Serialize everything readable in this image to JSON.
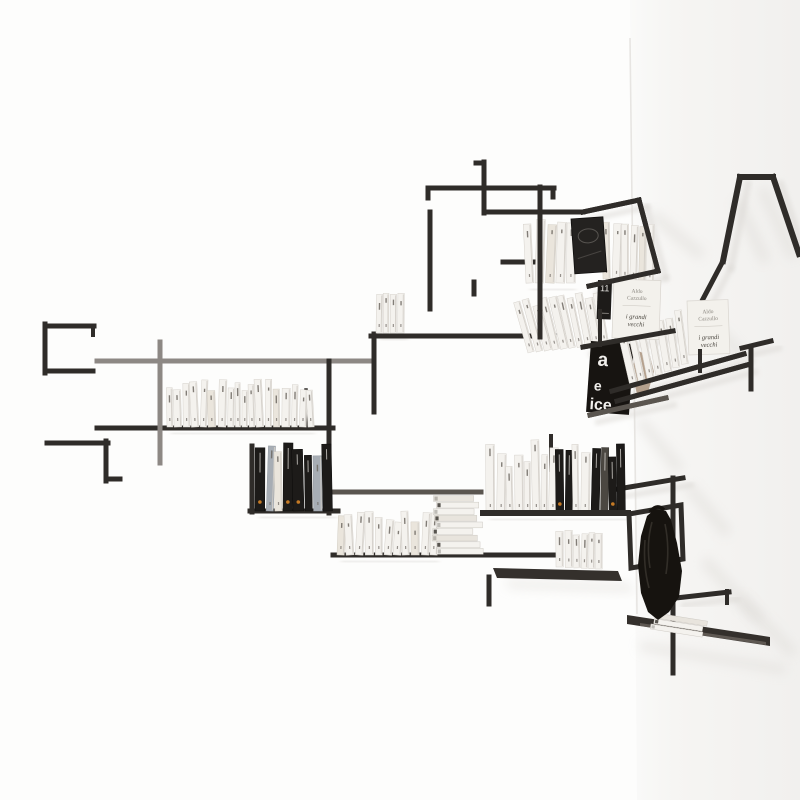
{
  "meta": {
    "subject": "wall-mounted modular rod bookshelf in white corner studio",
    "walls": "two white walls meeting at a corner, soft diagonal shadows on right wall"
  },
  "palette": {
    "wall": "#fdfdfc",
    "wall_right_a": "#fafaf9",
    "wall_right_b": "#f1f0ee",
    "corner": "#e7e5e2",
    "shadow": "#dcd9d5",
    "rod_dark": "#2f2c29",
    "rod_mid": "#5a554f",
    "rod_light": "#8d8884",
    "book_white": "#f4f2ee",
    "book_black": "#1d1b19",
    "accent_orange": "#c57a25",
    "plate": "#34302c",
    "plate_light": "#817a72",
    "bag": "#16130f",
    "bag_hi": "#3e3a33",
    "poster_bg": "#171411",
    "poster_text": "#f1efec",
    "cover_bg": "#f3f1ec",
    "cover_text": "#8a867f",
    "cover_text_dark": "#4a463f",
    "torn_paper": "#a9927b"
  },
  "texts": {
    "cover_author_line1": "Aldo",
    "cover_author_line2": "Cazzullo",
    "cover_title_line1": "i grandi",
    "cover_title_line2": "vecchi",
    "spine_number": "11",
    "poster_letters": [
      "a",
      "e",
      "ice"
    ]
  },
  "scene": {
    "seed": 11,
    "corner": {
      "x1": 630,
      "y1": 38,
      "x2": 637,
      "y2": 614
    },
    "rods": [
      [
        45,
        326,
        94,
        326,
        5,
        "d"
      ],
      [
        45,
        324,
        45,
        373,
        5,
        "d"
      ],
      [
        45,
        371,
        93,
        371,
        5,
        "d"
      ],
      [
        93,
        326,
        93,
        335,
        4,
        "d"
      ],
      [
        47,
        443,
        108,
        443,
        5,
        "d"
      ],
      [
        106,
        441,
        106,
        481,
        5,
        "d"
      ],
      [
        106,
        479,
        120,
        479,
        5,
        "d"
      ],
      [
        97,
        361,
        374,
        361,
        5,
        "l"
      ],
      [
        97,
        428,
        333,
        428,
        5,
        "d"
      ],
      [
        160,
        342,
        160,
        463,
        5,
        "l"
      ],
      [
        329,
        361,
        329,
        513,
        5,
        "d"
      ],
      [
        252,
        446,
        252,
        512,
        5,
        "d"
      ],
      [
        250,
        511,
        338,
        511,
        5,
        "d"
      ],
      [
        331,
        492,
        481,
        492,
        5,
        "m"
      ],
      [
        333,
        555,
        558,
        555,
        5,
        "d"
      ],
      [
        306,
        390,
        306,
        426,
        3.5,
        "d"
      ],
      [
        374,
        334,
        374,
        412,
        5,
        "d"
      ],
      [
        371,
        336,
        554,
        336,
        5,
        "d"
      ],
      [
        428,
        188,
        554,
        188,
        5,
        "d"
      ],
      [
        428,
        188,
        428,
        198,
        5,
        "d"
      ],
      [
        553,
        188,
        553,
        197,
        5,
        "d"
      ],
      [
        484,
        162,
        484,
        213,
        5,
        "d"
      ],
      [
        476,
        163,
        484,
        163,
        5,
        "d"
      ],
      [
        484,
        212,
        583,
        212,
        5,
        "d"
      ],
      [
        540,
        187,
        540,
        337,
        5,
        "d"
      ],
      [
        503,
        262,
        540,
        262,
        5,
        "d"
      ],
      [
        430,
        212,
        430,
        309,
        5,
        "d"
      ],
      [
        474,
        282,
        474,
        294,
        5,
        "d"
      ],
      [
        483,
        513,
        628,
        513,
        6,
        "d"
      ],
      [
        551,
        436,
        551,
        470,
        4,
        "d"
      ],
      [
        489,
        577,
        489,
        604,
        5,
        "d"
      ],
      [
        583,
        212,
        639,
        200,
        5,
        "d"
      ],
      [
        639,
        200,
        658,
        271,
        5,
        "d"
      ],
      [
        658,
        271,
        589,
        286,
        5,
        "d"
      ],
      [
        612,
        391,
        744,
        354,
        5,
        "d"
      ],
      [
        617,
        401,
        747,
        365,
        5,
        "d"
      ],
      [
        700,
        351,
        700,
        371,
        4,
        "d"
      ],
      [
        751,
        349,
        751,
        389,
        5,
        "d"
      ],
      [
        742,
        348,
        771,
        341,
        5,
        "d"
      ],
      [
        740,
        177,
        773,
        177,
        6,
        "d"
      ],
      [
        740,
        177,
        723,
        261,
        6,
        "d"
      ],
      [
        723,
        261,
        703,
        299,
        5,
        "d"
      ],
      [
        773,
        177,
        799,
        254,
        6,
        "d"
      ],
      [
        583,
        347,
        673,
        331,
        5,
        "d"
      ],
      [
        600,
        311,
        600,
        345,
        4,
        "d"
      ],
      [
        590,
        415,
        666,
        398,
        5,
        "m"
      ],
      [
        618,
        489,
        683,
        478,
        5,
        "d"
      ],
      [
        673,
        478,
        673,
        673,
        5,
        "d"
      ],
      [
        676,
        598,
        729,
        592,
        5,
        "d"
      ],
      [
        727,
        591,
        727,
        603,
        4,
        "d"
      ]
    ],
    "front_rods": [
      [
        540,
        187,
        540,
        337,
        5,
        "d"
      ],
      [
        583,
        212,
        639,
        200,
        5,
        "d"
      ],
      [
        639,
        200,
        658,
        271,
        5,
        "d"
      ],
      [
        658,
        271,
        589,
        286,
        5,
        "d"
      ],
      [
        612,
        391,
        744,
        354,
        5,
        "d"
      ],
      [
        617,
        401,
        747,
        365,
        5,
        "d"
      ],
      [
        700,
        351,
        700,
        371,
        4,
        "d"
      ],
      [
        583,
        347,
        673,
        331,
        5,
        "d"
      ],
      [
        600,
        311,
        600,
        345,
        4,
        "d"
      ],
      [
        590,
        415,
        666,
        398,
        5,
        "m"
      ],
      [
        483,
        513,
        628,
        513,
        6,
        "d"
      ]
    ],
    "loop_frame": "629,514 681,505 683,559 631,568",
    "plates": [
      {
        "points": "493,568 618,571 622,581 497,578",
        "fill": "plate",
        "opacity": 1
      },
      {
        "points": "627,615 770,637 770,646 627,624",
        "fill": "plate",
        "opacity": 1
      },
      {
        "points": "640,623 766,642 766,645 640,626",
        "fill": "plate_light",
        "opacity": 0.55
      }
    ],
    "plate_shadows": [
      "505,580 630,584 634,592 509,588",
      "640,642 786,666 786,674 640,650"
    ],
    "right_shadows": [
      [
        652,
        214,
        702,
        256
      ],
      [
        737,
        200,
        766,
        262
      ],
      [
        762,
        188,
        794,
        258
      ],
      [
        700,
        312,
        744,
        357
      ],
      [
        640,
        420,
        680,
        470
      ],
      [
        688,
        486,
        728,
        534
      ],
      [
        704,
        560,
        760,
        620
      ],
      [
        739,
        598,
        794,
        654
      ]
    ],
    "book_rows": [
      {
        "x0": 167,
        "x1": 309,
        "base": 427,
        "hmin": 36,
        "hmax": 48,
        "wmin": 5,
        "wmax": 8.5,
        "lean": 3,
        "pal": "w",
        "gap": 1.2
      },
      {
        "x0": 376,
        "x1": 402,
        "base": 333,
        "hmin": 37,
        "hmax": 41,
        "wmin": 5.5,
        "wmax": 7,
        "lean": 1,
        "pal": "w",
        "gap": 0.6
      },
      {
        "x0": 255,
        "x1": 331,
        "base": 511,
        "hmin": 52,
        "hmax": 70,
        "wmin": 6.5,
        "wmax": 11,
        "lean": 2,
        "pal": "mixL",
        "gap": 0.5
      },
      {
        "x0": 337,
        "x1": 433,
        "base": 555,
        "hmin": 32,
        "hmax": 44,
        "wmin": 6,
        "wmax": 8.5,
        "lean": 4,
        "pal": "w",
        "gap": 1
      },
      {
        "x0": 486,
        "x1": 553,
        "base": 513,
        "hmin": 46,
        "hmax": 74,
        "wmin": 6,
        "wmax": 9,
        "lean": 2,
        "pal": "w2",
        "gap": 0.7
      },
      {
        "x0": 556,
        "x1": 622,
        "base": 513,
        "hmin": 56,
        "hmax": 72,
        "wmin": 6,
        "wmax": 10,
        "lean": 1.5,
        "pal": "blk",
        "gap": 0.5
      },
      {
        "x0": 556,
        "x1": 599,
        "base": 567,
        "slope": 0.05,
        "hmin": 33,
        "hmax": 40,
        "wmin": 5.5,
        "wmax": 7.5,
        "lean": 2,
        "pal": "w",
        "gap": 0.8
      },
      {
        "x0": 526,
        "x1": 570,
        "base": 283,
        "hmin": 56,
        "hmax": 65,
        "wmin": 7,
        "wmax": 9.5,
        "lean": 3,
        "pal": "wg",
        "gap": 0.8
      },
      {
        "x0": 603,
        "x1": 647,
        "base": 279,
        "slope": 0.1,
        "hmin": 52,
        "hmax": 60,
        "wmin": 6,
        "wmax": 9,
        "lean": 2,
        "pal": "w",
        "gap": 0.8
      }
    ],
    "fans": [
      {
        "x0": 528,
        "n": 10,
        "dx": 8.2,
        "base": 353,
        "dbase": -0.9,
        "h": 50,
        "w": 7,
        "rot": -16,
        "drot": 0.7,
        "z": "back"
      },
      {
        "x0": 630,
        "n": 7,
        "dx": 8.6,
        "base": 386,
        "dbase": -3.6,
        "h": 52,
        "w": 7.5,
        "rot": -13,
        "drot": 0.9,
        "z": "front"
      }
    ],
    "flat_stacks": [
      {
        "x": 434,
        "y": 555,
        "n": 9,
        "w": 47,
        "h": 6.6,
        "jx": 3,
        "rot": 0
      },
      {
        "x": 652,
        "y": 630,
        "n": 3,
        "w": 56,
        "h": 5.8,
        "jx": 2,
        "rot": 9
      }
    ],
    "covers": [
      {
        "x": 614,
        "y": 279,
        "w": 47,
        "h": 59,
        "rot": 2
      },
      {
        "x": 687,
        "y": 301,
        "w": 41,
        "h": 54,
        "rot": -2
      }
    ],
    "album": {
      "x": 571,
      "y": 219,
      "w": 32,
      "h": 55,
      "rot": -4
    },
    "spine11": {
      "x": 598,
      "y": 280,
      "w": 14,
      "h": 39,
      "rot": 2
    },
    "poster": {
      "x": 591,
      "y": 341,
      "w": 43,
      "h": 71,
      "rot": 4
    },
    "torn_paper": "636,350 650,356 654,372 648,392 638,398 632,374",
    "bag": {
      "points": "655,509 666,511 671,520 677,543 682,571 679,597 669,612 658,620 648,612 641,593 638,565 641,536 647,516",
      "strap": "M650,512 q7,-9 14,-2",
      "folds": [
        "M652,522 q-6,22 -2,46",
        "M665,524 q5,24 1,50",
        "M645,540 q-2,26 4,48"
      ]
    }
  }
}
